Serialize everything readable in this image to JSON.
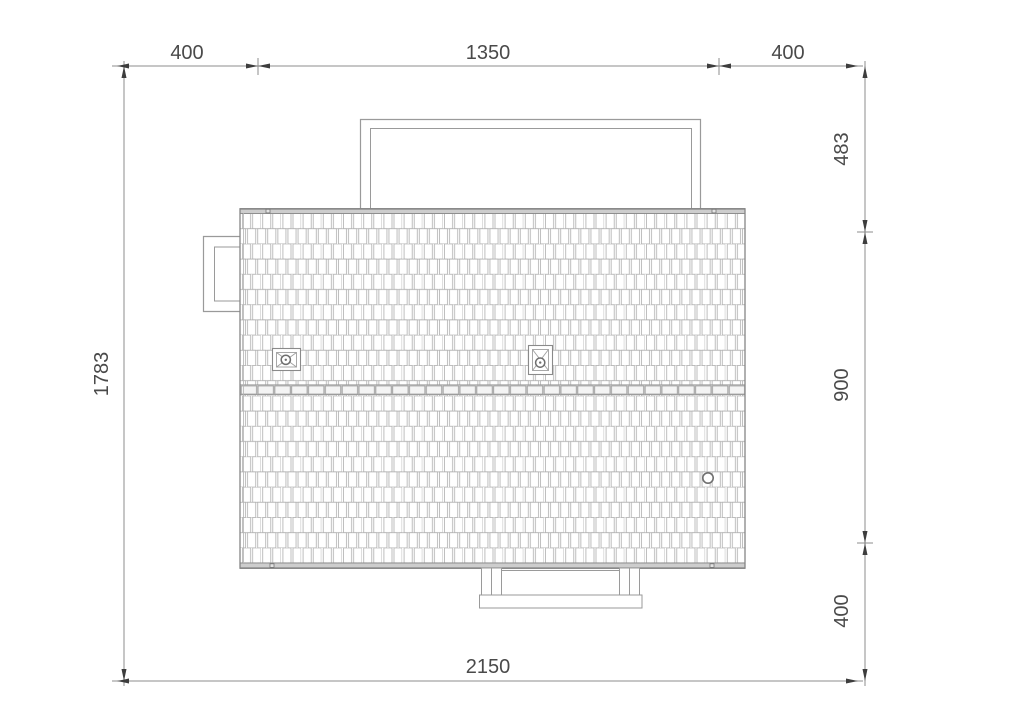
{
  "drawing": {
    "type": "roof-plan-top-view",
    "dims": {
      "top_left": "400",
      "top_mid": "1350",
      "top_right": "400",
      "left": "1783",
      "right_top": "483",
      "right_mid": "900",
      "right_bottom": "400",
      "bottom": "2150"
    },
    "features": {
      "roof_vents": 2,
      "pipe_penetrations": 1,
      "ridge": "horizontal ridge cap row",
      "outlines": [
        "top porch outline",
        "left dormer outline",
        "bottom porch with posts"
      ]
    },
    "colors": {
      "line": "#8a8a8a",
      "tile_line": "#aeaeae",
      "band_fill": "#cdcdcd",
      "ridge_fill": "#f4f4f4",
      "dim_line": "#8c8c8c",
      "arrow": "#3d3d3d",
      "dim_text": "#4a4a4a",
      "background": "#ffffff"
    }
  }
}
